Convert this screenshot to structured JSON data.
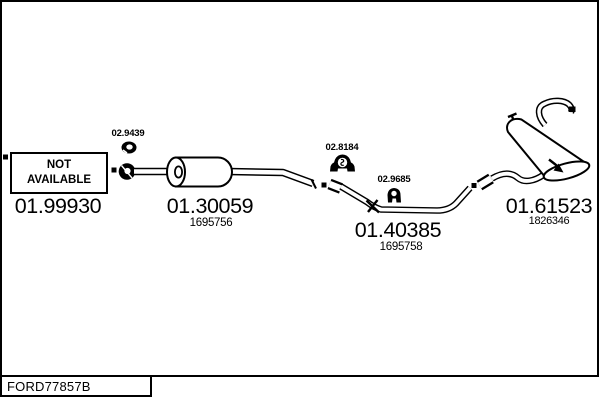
{
  "diagram": {
    "not_available": "NOT AVAILABLE",
    "catalog_code": "FORD77857B",
    "colors": {
      "line": "#000000",
      "background": "#ffffff"
    },
    "parts": {
      "front_pipe": {
        "number": "01.99930"
      },
      "center_muffler": {
        "number": "01.30059",
        "ref": "1695756"
      },
      "mid_pipe": {
        "number": "01.40385",
        "ref": "1695758"
      },
      "rear_muffler": {
        "number": "01.61523",
        "ref": "1826346"
      },
      "clamp": {
        "number": "02.9439"
      },
      "rubber_mount": {
        "number": "02.8184"
      },
      "hanger": {
        "number": "02.9685"
      }
    }
  }
}
